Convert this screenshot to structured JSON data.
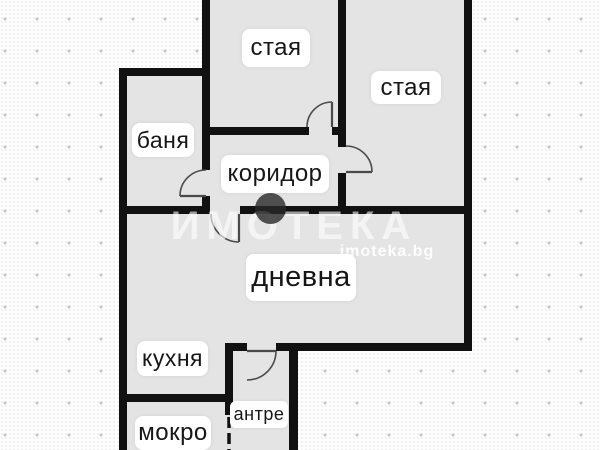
{
  "plan": {
    "type": "apartment-floor-plan",
    "rooms": [
      {
        "name": "room-top",
        "label": "стая"
      },
      {
        "name": "room-right",
        "label": "стая"
      },
      {
        "name": "bathroom",
        "label": "баня"
      },
      {
        "name": "corridor",
        "label": "коридор"
      },
      {
        "name": "living-room",
        "label": "дневна"
      },
      {
        "name": "kitchen",
        "label": "кухня"
      },
      {
        "name": "utility-room",
        "label": "мокро"
      },
      {
        "name": "entry-hall",
        "label": "антре"
      }
    ]
  },
  "watermark": {
    "brand": "ИМОТЕКА",
    "website": "imoteka.bg"
  },
  "colors": {
    "wall": "#111111",
    "room_fill": "#e4e4e4",
    "label_bg": "#ffffff",
    "label_text": "#161616",
    "background": "#fdfdfd",
    "dot": "#c4c4c4"
  }
}
